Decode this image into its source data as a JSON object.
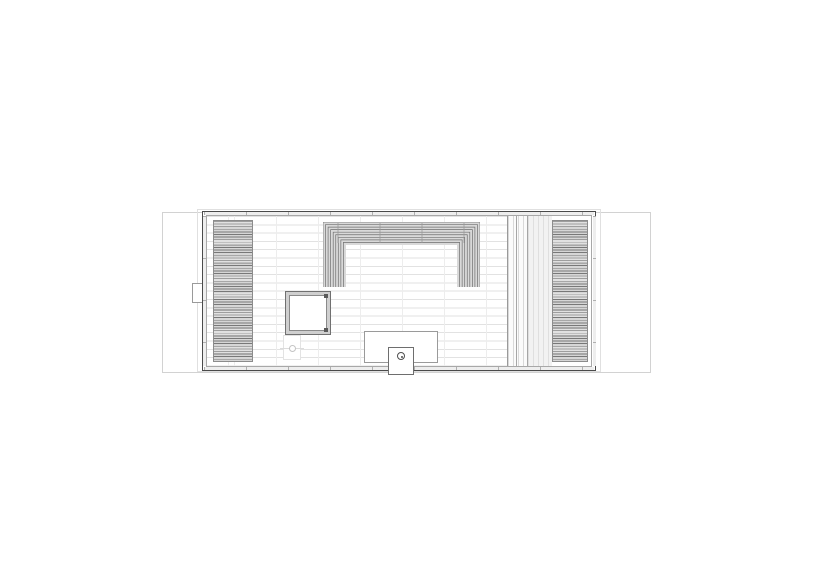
{
  "drawing": {
    "type": "architectural-floor-plan",
    "elements": [
      "deck-outline",
      "roof-overhang-outline",
      "building-wall",
      "left-louver-deck",
      "right-louver-deck",
      "right-vertical-plank-band",
      "plank-floor",
      "u-shaped-tiered-bench",
      "hinged-hatch-square",
      "floor-drain",
      "entry-platform",
      "chimney-flue",
      "side-vent"
    ]
  },
  "colors": {
    "background": "#ffffff",
    "wall_line": "#4a4a4a",
    "inner_wall_line": "#a8a8a8",
    "deck_line": "#d2d2d2",
    "overhang_line": "#e0e0e0",
    "louver_dark": "#787878",
    "louver_light": "#d6d6d6",
    "plank_line": "#e2e2e2",
    "joint_line": "#ededed",
    "bench_line": "#6f6f6f",
    "bench_fill": "#d9d9d9",
    "detail_line": "#9a9a9a",
    "tick_line": "#b0b0b0",
    "wall_fill": "#eeeeee"
  },
  "bench": {
    "width": 157,
    "height": 66,
    "nested_line_count": 9,
    "line_spacing_px": 2.55,
    "leg_inner_offset": 23,
    "joint_tick_offsets": [
      15,
      57,
      99,
      141
    ]
  }
}
